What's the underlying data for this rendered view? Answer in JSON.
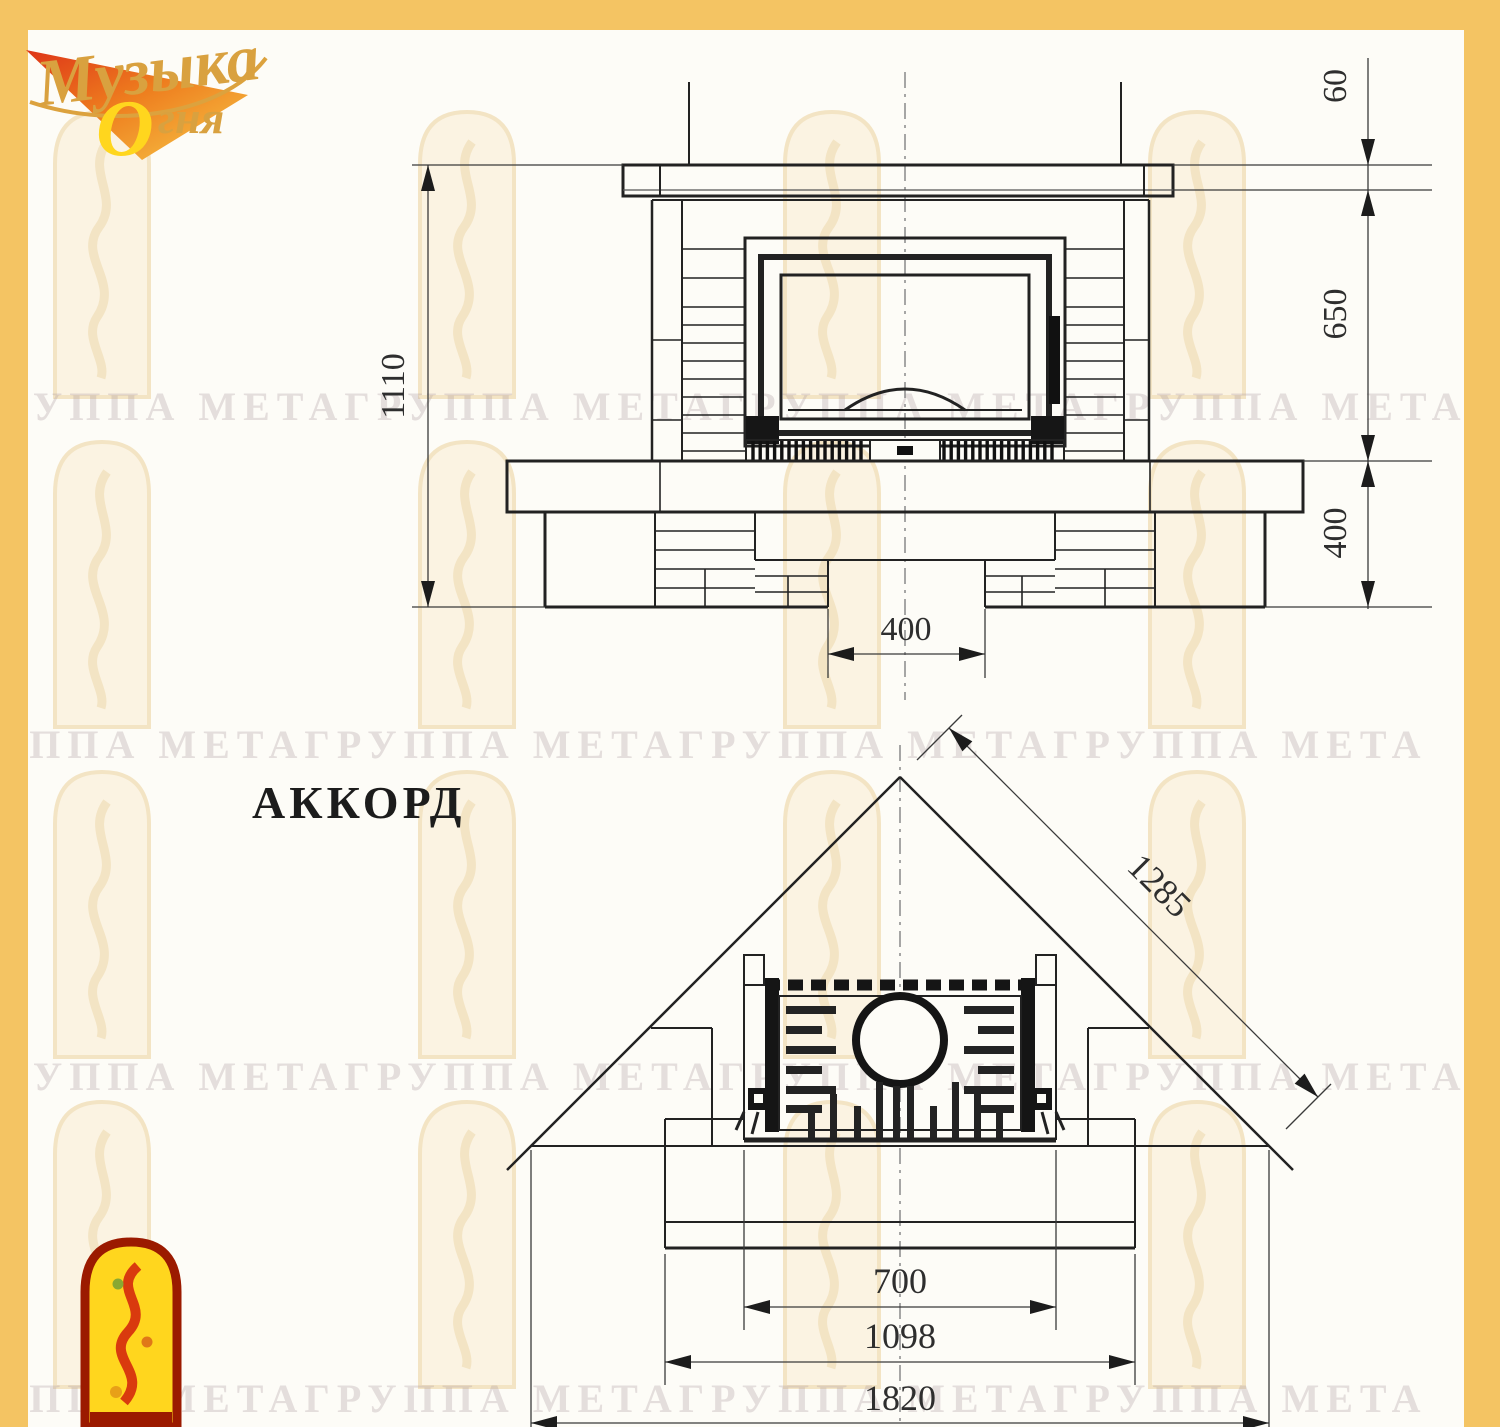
{
  "page": {
    "title_label": "АККОРД"
  },
  "logo": {
    "line1": "Музыка",
    "line2_initial": "О",
    "line2_rest": "гня"
  },
  "watermark": {
    "row_text": "ГРУППА МЕТАГРУППА МЕТАГРУППА МЕТАГРУППА МЕТА"
  },
  "front_view": {
    "dims": {
      "total_height": "1110",
      "shelf_thickness": "60",
      "upper_section": "650",
      "base_section": "400",
      "bottom_opening": "400"
    }
  },
  "plan_view": {
    "dims": {
      "diagonal": "1285",
      "firebox_opening": "700",
      "body_width": "1098",
      "overall_width": "1820"
    }
  },
  "colors": {
    "frame_yellow": "#f4c463",
    "logo_gold": "#d9a13f",
    "logo_deep_gold": "#c88f1a",
    "emblem_red": "#9b1a00",
    "emblem_flame": "#d93a0e",
    "emblem_yellow": "#ffd61e",
    "line_dark": "#1f1f1f",
    "watermark_arch": "#f3e4c4"
  }
}
